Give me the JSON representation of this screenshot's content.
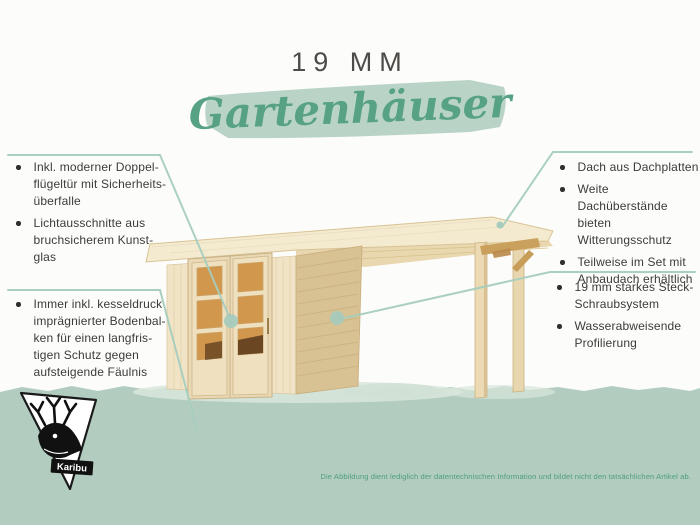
{
  "title": "19 MM",
  "subtitle": "Gartenhäuser",
  "callouts": {
    "left_top": {
      "items": [
        [
          "Inkl. moderner Doppel-",
          "flügeltür mit Sicherheits-",
          "überfalle"
        ],
        [
          "Lichtausschnitte aus",
          "bruchsicherem Kunst-",
          "glas"
        ]
      ]
    },
    "left_bottom": {
      "items": [
        [
          "Immer inkl. kesseldruck",
          "imprägnierter Bodenbal-",
          "ken für einen langfris-",
          "tigen Schutz gegen",
          "aufsteigende Fäulnis"
        ]
      ]
    },
    "right_top": {
      "items": [
        [
          "Dach aus Dachplatten"
        ],
        [
          "Weite Dachüberstände",
          "bieten Witterungsschutz"
        ],
        [
          "Teilweise im Set mit",
          "Anbaudach erhältlich"
        ]
      ]
    },
    "right_bottom": {
      "items": [
        [
          "19 mm starkes Steck-",
          "Schraubsystem"
        ],
        [
          "Wasserabweisende",
          "Profilierung"
        ]
      ]
    }
  },
  "brand": {
    "logo_text": "Karibu",
    "logo_icon": "deer-icon"
  },
  "footer": {
    "disclaimer": "Die Abbildung dient lediglich der datentechnischen Information und bildet nicht den tatsächlichen Artikel ab."
  },
  "colors": {
    "background": "#fcfcfa",
    "bottom_band": "#b2cdc0",
    "brush_stroke": "#b9d4c7",
    "script_green": "#57a184",
    "callout_line": "#a6cdbf",
    "callout_dot": "#a5cbbd",
    "body_text": "#3b3b3a",
    "title_text": "#4c4b47",
    "disclaimer_text": "#4f9e7e",
    "wood_light": "#f4ead0",
    "wood_side": "#d8c192",
    "window_amber": "#d0974d"
  }
}
